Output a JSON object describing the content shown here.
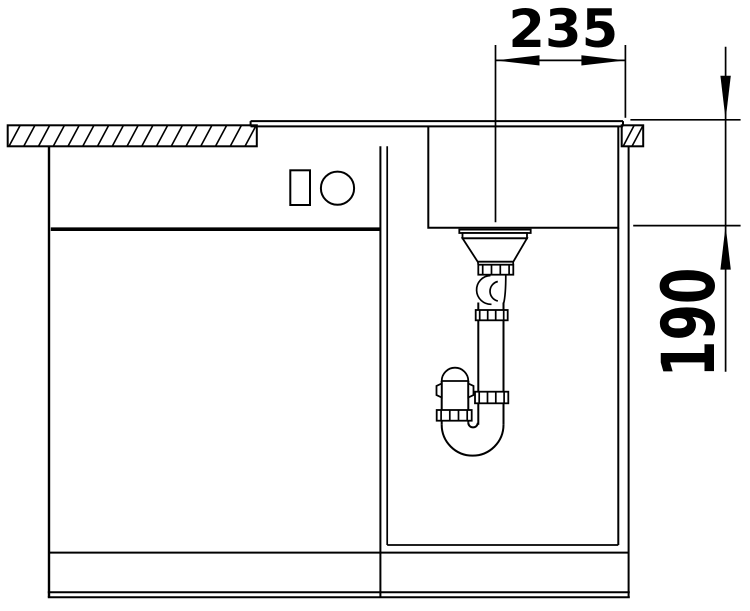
{
  "drawing": {
    "background_color": "#ffffff",
    "line_color": "#000000"
  },
  "dimensions": {
    "horizontal": {
      "value": "235"
    },
    "vertical": {
      "value": "190"
    }
  }
}
